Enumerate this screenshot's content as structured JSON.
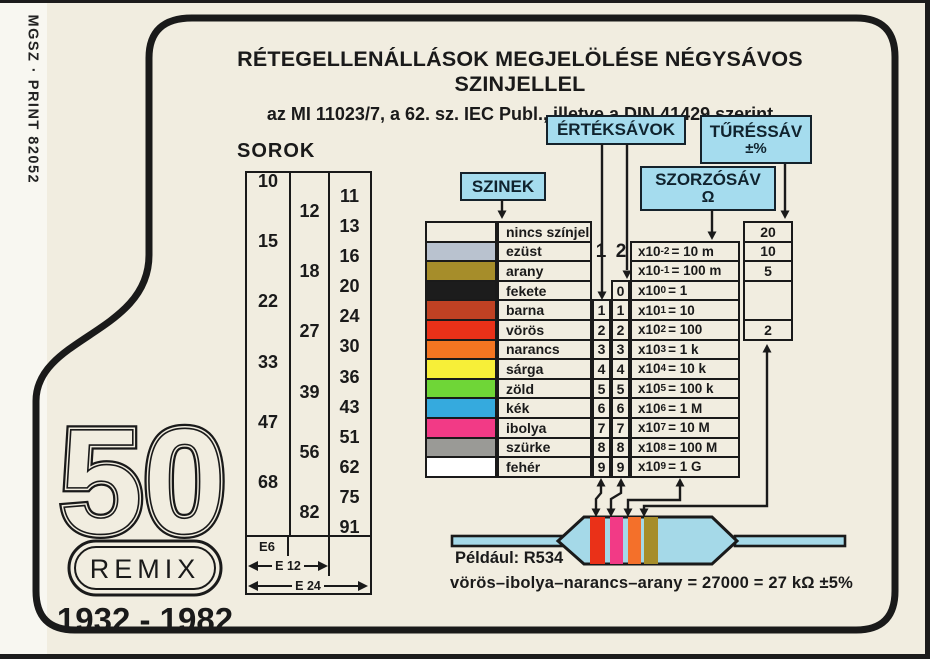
{
  "side_text": "MGSZ · PRINT 82052",
  "title": {
    "line1": "RÉTEGELLENÁLLÁSOK MEGJELÖLÉSE NÉGYSÁVOS SZINJELLEL",
    "line2": "az MI 11023/7, a 62. sz. IEC Publ., illetve a DIN 41429 szerint"
  },
  "sorok": {
    "label": "SOROK",
    "e6": [
      "10",
      "15",
      "22",
      "33",
      "47",
      "68"
    ],
    "e12": [
      "12",
      "18",
      "27",
      "39",
      "56",
      "82"
    ],
    "e24": [
      "11",
      "13",
      "16",
      "20",
      "24",
      "30",
      "36",
      "43",
      "51",
      "62",
      "75",
      "91"
    ],
    "footer": {
      "e6": "E6",
      "e12": "E 12",
      "e24": "E 24"
    }
  },
  "labels": {
    "szinek": "SZINEK",
    "erteksavok": "ÉRTÉKSÁVOK",
    "turessav": "TŰRÉSSÁV",
    "turessav_sub": "±%",
    "szorzosav": "SZORZÓSÁV",
    "szorzosav_sub": "Ω"
  },
  "band_headers": {
    "first": "1",
    "second": "2"
  },
  "color_table": {
    "rows": [
      {
        "name": "nincs színjel",
        "color": "#f1ede0",
        "tol": "20"
      },
      {
        "name": "ezüst",
        "color": "#b9c2cf",
        "mult": {
          "base": "x10",
          "exp": "-2",
          "eq": "= 10 m"
        },
        "tol": "10"
      },
      {
        "name": "arany",
        "color": "#a68d2a",
        "mult": {
          "base": "x10",
          "exp": "-1",
          "eq": "= 100 m"
        },
        "tol": "5"
      },
      {
        "name": "fekete",
        "color": "#1c1c1c",
        "d2": "0",
        "mult": {
          "base": "x10",
          "exp": "0",
          "eq": "= 1"
        }
      },
      {
        "name": "barna",
        "color": "#c04123",
        "d1": "1",
        "d2": "1",
        "mult": {
          "base": "x10",
          "exp": "1",
          "eq": "= 10"
        }
      },
      {
        "name": "vörös",
        "color": "#ea3118",
        "d1": "2",
        "d2": "2",
        "mult": {
          "base": "x10",
          "exp": "2",
          "eq": "= 100"
        },
        "tol": "2"
      },
      {
        "name": "narancs",
        "color": "#f47521",
        "d1": "3",
        "d2": "3",
        "mult": {
          "base": "x10",
          "exp": "3",
          "eq": "= 1 k"
        }
      },
      {
        "name": "sárga",
        "color": "#f7ef38",
        "d1": "4",
        "d2": "4",
        "mult": {
          "base": "x10",
          "exp": "4",
          "eq": "= 10 k"
        }
      },
      {
        "name": "zöld",
        "color": "#6fd637",
        "d1": "5",
        "d2": "5",
        "mult": {
          "base": "x10",
          "exp": "5",
          "eq": "= 100 k"
        }
      },
      {
        "name": "kék",
        "color": "#35aade",
        "d1": "6",
        "d2": "6",
        "mult": {
          "base": "x10",
          "exp": "6",
          "eq": "= 1 M"
        }
      },
      {
        "name": "ibolya",
        "color": "#f23a86",
        "d1": "7",
        "d2": "7",
        "mult": {
          "base": "x10",
          "exp": "7",
          "eq": "= 10 M"
        }
      },
      {
        "name": "szürke",
        "color": "#9a9a96",
        "d1": "8",
        "d2": "8",
        "mult": {
          "base": "x10",
          "exp": "8",
          "eq": "= 100 M"
        }
      },
      {
        "name": "fehér",
        "color": "#ffffff",
        "d1": "9",
        "d2": "9",
        "mult": {
          "base": "x10",
          "exp": "9",
          "eq": "= 1 G"
        }
      }
    ]
  },
  "resistor": {
    "body_color": "#a5d9e8",
    "band_colors": [
      "#ea3118",
      "#f23a86",
      "#f4702a",
      "#a68d2a"
    ]
  },
  "example": {
    "label": "Például: R534",
    "formula": "vörös–ibolya–narancs–arany = 27000 = 27 kΩ ±5%"
  },
  "logo": {
    "number": "50",
    "name": "REMIX",
    "years": "1932 - 1982"
  },
  "frame_color": "#1a1a1a",
  "accent_color": "#a5dcee"
}
